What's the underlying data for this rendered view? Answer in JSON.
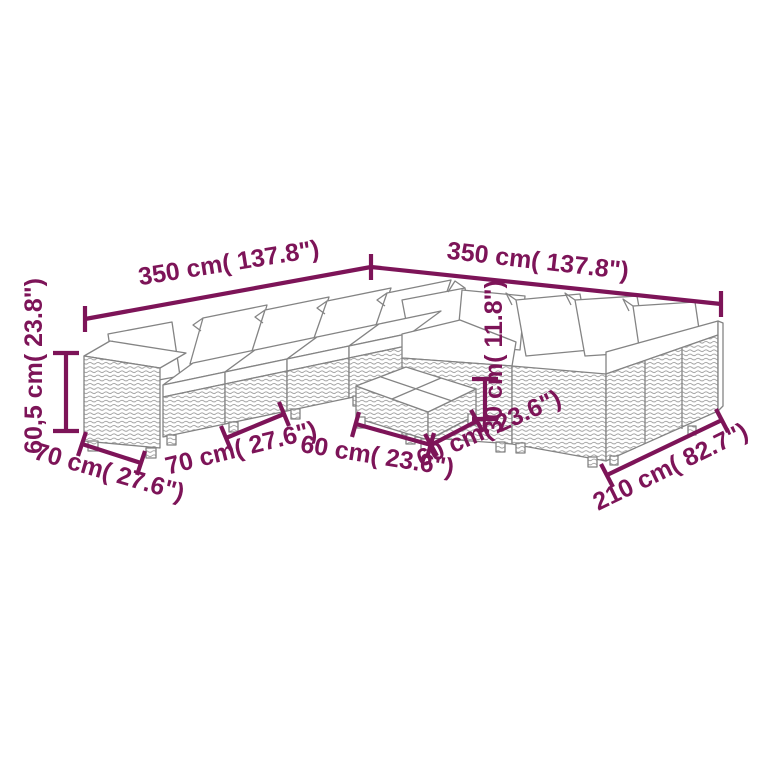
{
  "page": {
    "background": "#ffffff",
    "accent_color": "#7d1458",
    "line_art_color": "#848484"
  },
  "diagram": {
    "type": "furniture-dimension-diagram",
    "subject": "rattan-lounge-sofa-set-with-coffee-table",
    "dimensions": [
      {
        "id": "width-left",
        "label": "350 cm( 137.8\")"
      },
      {
        "id": "width-right",
        "label": "350 cm( 137.8\")"
      },
      {
        "id": "sofa-height",
        "label": "60,5 cm( 23.8\")"
      },
      {
        "id": "arm-depth",
        "label": "70 cm( 27.6\")"
      },
      {
        "id": "seat-width",
        "label": "70 cm( 27.6\")"
      },
      {
        "id": "table-width",
        "label": "60 cm( 23.6\")"
      },
      {
        "id": "table-depth",
        "label": "60 cm( 23.6\")"
      },
      {
        "id": "table-height",
        "label": "30 cm( 11.8\")"
      },
      {
        "id": "right-depth",
        "label": "210 cm( 82.7\")"
      }
    ]
  }
}
